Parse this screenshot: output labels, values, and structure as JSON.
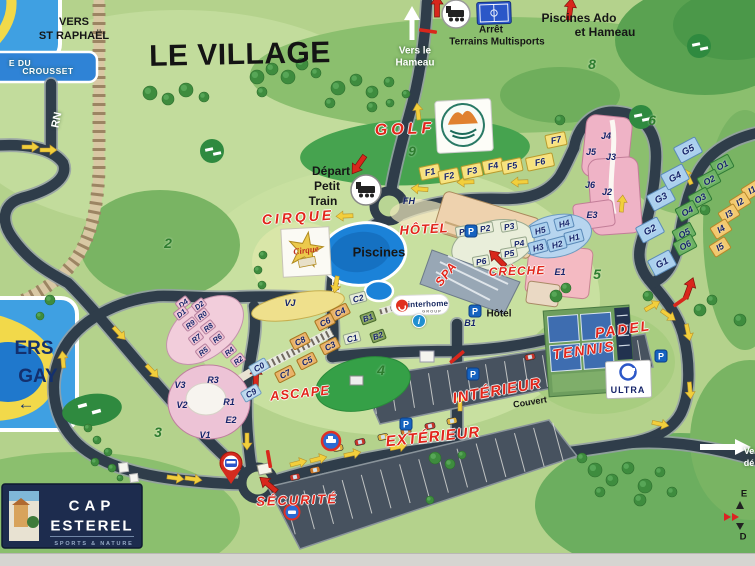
{
  "title": "LE VILLAGE",
  "colors": {
    "road": "#2f3d4a",
    "water": "#1b82d8",
    "accent_red": "#e2261b",
    "arrow_yellow": "#f2cf3c",
    "sign_blue": "#3fa0e2",
    "logo_navy": "#1d2c4e"
  },
  "signs": {
    "st_raphael": {
      "line1": "VERS",
      "line2": "ST RAPHAËL"
    },
    "road_sign_top": {
      "line1": "E DU",
      "line2": "CROUSSET"
    },
    "agay": {
      "line1": "ERS",
      "line2": "GAY",
      "arrow": "←"
    },
    "rn": "RN",
    "hameau": {
      "line1": "Vers le",
      "line2": "Hameau"
    },
    "exit_truncated": {
      "line1": "Ve",
      "line2": "dé"
    },
    "edge_fragments": {
      "top": "E",
      "bottom": "D"
    }
  },
  "poi_red": [
    {
      "t": "GOLF",
      "x": 405,
      "y": 130,
      "s": 16,
      "ls": 4,
      "r": -2
    },
    {
      "t": "CIRQUE",
      "x": 298,
      "y": 217,
      "s": 14,
      "ls": 3,
      "r": -4
    },
    {
      "t": "HÔTEL",
      "x": 424,
      "y": 229,
      "s": 13,
      "ls": 1,
      "r": -3
    },
    {
      "t": "SPA",
      "x": 446,
      "y": 274,
      "s": 12,
      "ls": 1,
      "r": -52
    },
    {
      "t": "CRÈCHE",
      "x": 517,
      "y": 271,
      "s": 12,
      "ls": 1,
      "r": -2
    },
    {
      "t": "PADEL",
      "x": 623,
      "y": 329,
      "s": 14,
      "ls": 2,
      "r": -8
    },
    {
      "t": "TENNIS",
      "x": 584,
      "y": 350,
      "s": 14,
      "ls": 2,
      "r": -8
    },
    {
      "t": "ASCAPE",
      "x": 300,
      "y": 393,
      "s": 13,
      "ls": 1,
      "r": -6
    },
    {
      "t": "INTÉRIEUR",
      "x": 497,
      "y": 391,
      "s": 15,
      "ls": 1,
      "r": -10
    },
    {
      "t": "EXTÉRIEUR",
      "x": 433,
      "y": 437,
      "s": 15,
      "ls": 1,
      "r": -6
    },
    {
      "t": "SÉCURITÉ",
      "x": 297,
      "y": 500,
      "s": 13,
      "ls": 2,
      "r": -2
    }
  ],
  "poi_black": [
    {
      "t": "Arrêt",
      "x": 491,
      "y": 30,
      "s": 10
    },
    {
      "t": "Terrains Multisports",
      "x": 497,
      "y": 42,
      "s": 10
    },
    {
      "t": "Piscines Ado",
      "x": 579,
      "y": 18,
      "s": 12
    },
    {
      "t": "et Hameau",
      "x": 605,
      "y": 32,
      "s": 12
    },
    {
      "t": "Départ",
      "x": 331,
      "y": 171,
      "s": 12
    },
    {
      "t": "Petit",
      "x": 327,
      "y": 186,
      "s": 12
    },
    {
      "t": "Train",
      "x": 323,
      "y": 201,
      "s": 12
    },
    {
      "t": "Piscines",
      "x": 379,
      "y": 252,
      "s": 13
    },
    {
      "t": "Hôtel",
      "x": 499,
      "y": 314,
      "s": 10
    },
    {
      "t": "Couvert",
      "x": 530,
      "y": 402,
      "s": 9,
      "r": -9
    }
  ],
  "poi_white": [
    {
      "t": "Vers le",
      "x": 415,
      "y": 51,
      "s": 10
    },
    {
      "t": "Hameau",
      "x": 415,
      "y": 63,
      "s": 10
    },
    {
      "t": "RN",
      "x": 57,
      "y": 120,
      "s": 11,
      "r": -78
    },
    {
      "t": "Ve",
      "x": 749,
      "y": 451,
      "s": 9
    },
    {
      "t": "dé",
      "x": 749,
      "y": 463,
      "s": 9
    }
  ],
  "zones": [
    {
      "n": "2",
      "x": 168,
      "y": 243
    },
    {
      "n": "3",
      "x": 158,
      "y": 432
    },
    {
      "n": "4",
      "x": 381,
      "y": 370
    },
    {
      "n": "5",
      "x": 597,
      "y": 274
    },
    {
      "n": "6",
      "x": 652,
      "y": 120
    },
    {
      "n": "8",
      "x": 592,
      "y": 64
    },
    {
      "n": "9",
      "x": 412,
      "y": 151
    }
  ],
  "buildings": [
    {
      "id": "F1",
      "x": 430,
      "y": 172,
      "g": "F"
    },
    {
      "id": "F2",
      "x": 449,
      "y": 176,
      "g": "F"
    },
    {
      "id": "F3",
      "x": 472,
      "y": 171,
      "g": "F"
    },
    {
      "id": "F4",
      "x": 493,
      "y": 166,
      "g": "F"
    },
    {
      "id": "F5",
      "x": 512,
      "y": 166,
      "g": "F"
    },
    {
      "id": "F6",
      "x": 540,
      "y": 162,
      "g": "F",
      "w": 28
    },
    {
      "id": "F7",
      "x": 556,
      "y": 140,
      "g": "F"
    },
    {
      "id": "FH",
      "x": 409,
      "y": 201,
      "g": "X"
    },
    {
      "id": "P1",
      "x": 464,
      "y": 231,
      "g": "P"
    },
    {
      "id": "P2",
      "x": 485,
      "y": 228,
      "g": "P"
    },
    {
      "id": "P3",
      "x": 509,
      "y": 226,
      "g": "P"
    },
    {
      "id": "P4",
      "x": 519,
      "y": 243,
      "g": "P"
    },
    {
      "id": "P5",
      "x": 509,
      "y": 253,
      "g": "P"
    },
    {
      "id": "P6",
      "x": 481,
      "y": 261,
      "g": "P"
    },
    {
      "id": "H1",
      "x": 574,
      "y": 237,
      "g": "H"
    },
    {
      "id": "H2",
      "x": 557,
      "y": 244,
      "g": "H"
    },
    {
      "id": "H3",
      "x": 538,
      "y": 247,
      "g": "H"
    },
    {
      "id": "H4",
      "x": 564,
      "y": 223,
      "g": "H"
    },
    {
      "id": "H5",
      "x": 540,
      "y": 230,
      "g": "H"
    },
    {
      "id": "J2",
      "x": 607,
      "y": 192,
      "g": "X"
    },
    {
      "id": "J3",
      "x": 611,
      "y": 157,
      "g": "X"
    },
    {
      "id": "J4",
      "x": 606,
      "y": 136,
      "g": "X"
    },
    {
      "id": "J5",
      "x": 591,
      "y": 152,
      "g": "X"
    },
    {
      "id": "J6",
      "x": 590,
      "y": 185,
      "g": "X"
    },
    {
      "id": "E1",
      "x": 560,
      "y": 272,
      "g": "X"
    },
    {
      "id": "E2",
      "x": 231,
      "y": 420,
      "g": "X"
    },
    {
      "id": "E3",
      "x": 592,
      "y": 215,
      "g": "X"
    },
    {
      "id": "G1",
      "x": 662,
      "y": 263,
      "g": "G"
    },
    {
      "id": "G2",
      "x": 650,
      "y": 230,
      "g": "G"
    },
    {
      "id": "G3",
      "x": 661,
      "y": 198,
      "g": "G"
    },
    {
      "id": "G4",
      "x": 675,
      "y": 177,
      "g": "G"
    },
    {
      "id": "G5",
      "x": 688,
      "y": 150,
      "g": "G"
    },
    {
      "id": "O1",
      "x": 722,
      "y": 165,
      "g": "O"
    },
    {
      "id": "O2",
      "x": 709,
      "y": 180,
      "g": "O"
    },
    {
      "id": "O3",
      "x": 700,
      "y": 198,
      "g": "O"
    },
    {
      "id": "O4",
      "x": 687,
      "y": 211,
      "g": "O"
    },
    {
      "id": "O5",
      "x": 684,
      "y": 233,
      "g": "O"
    },
    {
      "id": "O6",
      "x": 685,
      "y": 245,
      "g": "O"
    },
    {
      "id": "I1",
      "x": 752,
      "y": 190,
      "g": "I"
    },
    {
      "id": "I2",
      "x": 740,
      "y": 202,
      "g": "I"
    },
    {
      "id": "I3",
      "x": 729,
      "y": 214,
      "g": "I"
    },
    {
      "id": "I4",
      "x": 721,
      "y": 229,
      "g": "I"
    },
    {
      "id": "I5",
      "x": 720,
      "y": 247,
      "g": "I"
    },
    {
      "id": "C3",
      "x": 330,
      "y": 346,
      "g": "C"
    },
    {
      "id": "C4",
      "x": 340,
      "y": 312,
      "g": "C"
    },
    {
      "id": "C5",
      "x": 307,
      "y": 361,
      "g": "C"
    },
    {
      "id": "C6",
      "x": 325,
      "y": 322,
      "g": "C"
    },
    {
      "id": "C7",
      "x": 285,
      "y": 374,
      "g": "C"
    },
    {
      "id": "C8",
      "x": 300,
      "y": 341,
      "g": "C"
    },
    {
      "id": "C0",
      "x": 259,
      "y": 367,
      "g": "CB"
    },
    {
      "id": "C9",
      "x": 251,
      "y": 393,
      "g": "CB"
    },
    {
      "id": "C1",
      "x": 352,
      "y": 338,
      "g": "CP"
    },
    {
      "id": "C2",
      "x": 358,
      "y": 298,
      "g": "CP"
    },
    {
      "id": "B1",
      "x": 368,
      "y": 318,
      "g": "B"
    },
    {
      "id": "B2",
      "x": 378,
      "y": 336,
      "g": "B"
    },
    {
      "id": "B1",
      "x": 470,
      "y": 323,
      "g": "X"
    },
    {
      "id": "D4",
      "x": 183,
      "y": 303,
      "g": "DR"
    },
    {
      "id": "D2",
      "x": 199,
      "y": 305,
      "g": "DR"
    },
    {
      "id": "D1",
      "x": 181,
      "y": 313,
      "g": "DR"
    },
    {
      "id": "R0",
      "x": 202,
      "y": 315,
      "g": "DR"
    },
    {
      "id": "R9",
      "x": 190,
      "y": 324,
      "g": "DR"
    },
    {
      "id": "R8",
      "x": 208,
      "y": 327,
      "g": "DR"
    },
    {
      "id": "R7",
      "x": 196,
      "y": 338,
      "g": "DR"
    },
    {
      "id": "R6",
      "x": 217,
      "y": 338,
      "g": "DR"
    },
    {
      "id": "R5",
      "x": 203,
      "y": 351,
      "g": "DR"
    },
    {
      "id": "R4",
      "x": 229,
      "y": 351,
      "g": "DR"
    },
    {
      "id": "R2",
      "x": 238,
      "y": 360,
      "g": "DR"
    },
    {
      "id": "R3",
      "x": 213,
      "y": 380,
      "g": "X"
    },
    {
      "id": "R1",
      "x": 229,
      "y": 402,
      "g": "X"
    },
    {
      "id": "V1",
      "x": 205,
      "y": 435,
      "g": "X"
    },
    {
      "id": "V2",
      "x": 182,
      "y": 405,
      "g": "X"
    },
    {
      "id": "V3",
      "x": 180,
      "y": 385,
      "g": "X"
    },
    {
      "id": "VJ",
      "x": 290,
      "y": 303,
      "g": "X"
    }
  ],
  "icons": {
    "parking_letter": "P",
    "info_letter": "i",
    "parking_positions": [
      [
        471,
        231
      ],
      [
        475,
        311
      ],
      [
        473,
        374
      ],
      [
        406,
        424
      ],
      [
        661,
        356
      ]
    ],
    "info_position": [
      419,
      321
    ]
  },
  "logos": {
    "cap_esterel": {
      "line1": "CAP",
      "line2": "ESTEREL",
      "tagline": "SPORTS & NATURE"
    },
    "interhome": {
      "text": "interhome",
      "sub": "GROUP"
    },
    "ultra": {
      "text": "ULTRA"
    },
    "cirque": {
      "text": "Cirque"
    },
    "golf": {
      "name": "golf-cap-esterel-logo"
    }
  }
}
